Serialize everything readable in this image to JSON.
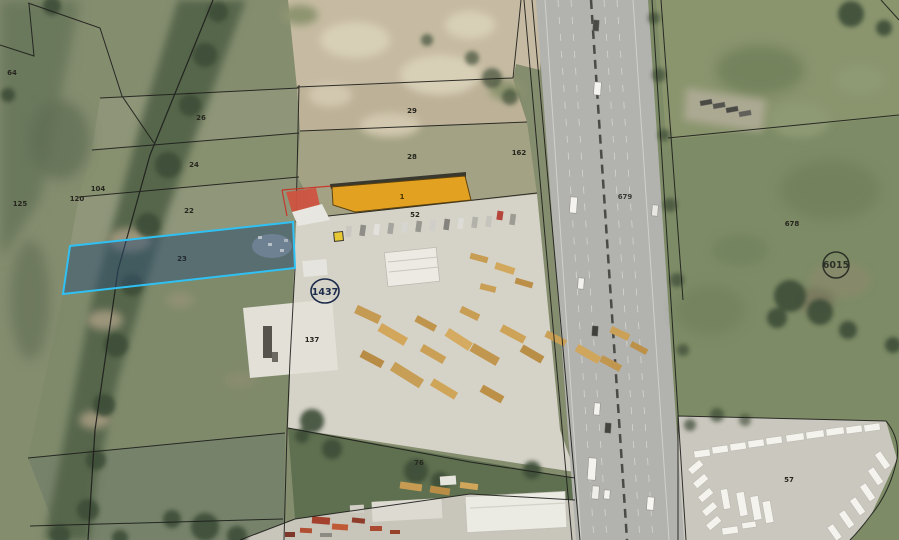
{
  "map": {
    "parcel_labels": [
      {
        "text": "64"
      },
      {
        "text": "26"
      },
      {
        "text": "24"
      },
      {
        "text": "104"
      },
      {
        "text": "120"
      },
      {
        "text": "125"
      },
      {
        "text": "22"
      },
      {
        "text": "23"
      },
      {
        "text": "29"
      },
      {
        "text": "28"
      },
      {
        "text": "162"
      },
      {
        "text": "52"
      },
      {
        "text": "137"
      },
      {
        "text": "76"
      },
      {
        "text": "679"
      },
      {
        "text": "678"
      },
      {
        "text": "57"
      }
    ],
    "cadastral_numbers": [
      {
        "text": "1437"
      },
      {
        "text": "6015"
      }
    ],
    "highlighted_building": {
      "label": "1",
      "fill": "#e3a122",
      "stroke": "#5c4210"
    },
    "highlighted_parcel": {
      "fill": "#2e4f74",
      "stroke": "#2fc1f3",
      "opacity": "0.5"
    },
    "marker": {
      "fill": "#e8c832"
    }
  }
}
